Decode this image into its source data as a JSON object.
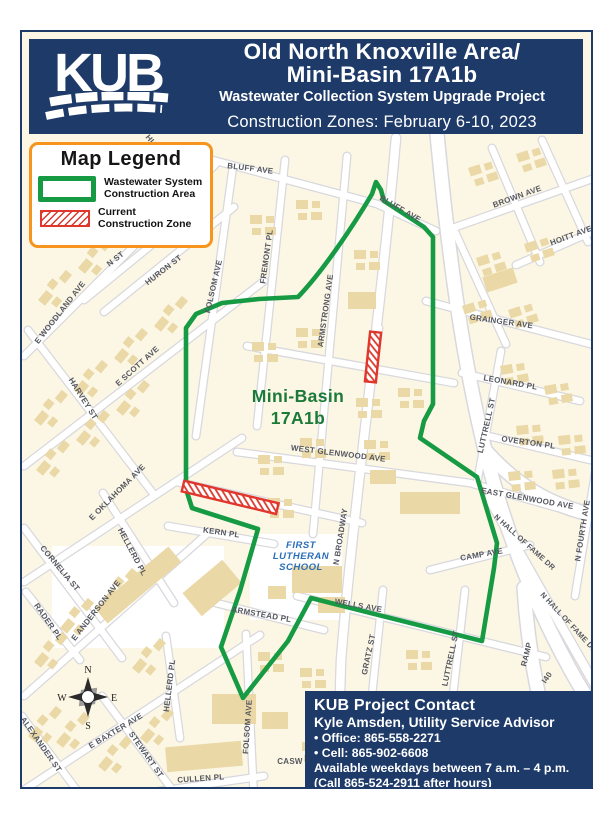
{
  "header": {
    "logo_text": "KUB",
    "title_line1": "Old North Knoxville Area/",
    "title_line2": "Mini-Basin 17A1b",
    "subtitle": "Wastewater Collection System Upgrade Project",
    "banner": "Construction Zones: February 6-10, 2023"
  },
  "legend": {
    "title": "Map Legend",
    "items": [
      {
        "swatch": "green-outline",
        "label_line1": "Wastewater System",
        "label_line2": "Construction Area"
      },
      {
        "swatch": "red-hatched",
        "label_line1": "Current",
        "label_line2": "Construction Zone"
      }
    ]
  },
  "map": {
    "basin_label_line1": "Mini-Basin",
    "basin_label_line2": "17A1b",
    "school_label": [
      "FIRST",
      "LUTHERAN",
      "SCHOOL"
    ],
    "compass": {
      "n": "N",
      "s": "S",
      "e": "E",
      "w": "W"
    },
    "colors": {
      "construction_area_green": "#169a43",
      "construction_zone_red": "#e0362b",
      "map_background": "#fcf7e5",
      "building_tan": "#ead8a6",
      "navy": "#1d3a69",
      "legend_orange": "#f7941d"
    },
    "street_labels": [
      {
        "text": "BLUFF AVE"
      },
      {
        "text": "BLUFF AVE"
      },
      {
        "text": "BROWN AVE"
      },
      {
        "text": "HOITT AVE"
      },
      {
        "text": "GRAINGER AVE"
      },
      {
        "text": "LEONARD PL"
      },
      {
        "text": "LUTTRELL ST"
      },
      {
        "text": "OVERTON PL"
      },
      {
        "text": "EAST GLENWOOD AVE"
      },
      {
        "text": "N FOURTH AVE"
      },
      {
        "text": "N HALL OF FAME DR"
      },
      {
        "text": "N HALL OF FAME DR"
      },
      {
        "text": "RAMP"
      },
      {
        "text": "I40"
      },
      {
        "text": "CAMP AVE"
      },
      {
        "text": "WELLS AVE"
      },
      {
        "text": "GRATZ ST"
      },
      {
        "text": "LUTTRELL ST"
      },
      {
        "text": "N BROADWAY"
      },
      {
        "text": "WEST GLENWOOD AVE"
      },
      {
        "text": "ARMSTEAD PL"
      },
      {
        "text": "KERN PL"
      },
      {
        "text": "ARMSTRONG AVE"
      },
      {
        "text": "FREMONT PL"
      },
      {
        "text": "FOLSOM AVE"
      },
      {
        "text": "FOLSOM AVE"
      },
      {
        "text": "HELLERD PL"
      },
      {
        "text": "HELLERD PL"
      },
      {
        "text": "HURON ST"
      },
      {
        "text": "N ST"
      },
      {
        "text": "E WOODLAND AVE"
      },
      {
        "text": "E SCOTT AVE"
      },
      {
        "text": "HARVEY ST"
      },
      {
        "text": "E OKLAHOMA AVE"
      },
      {
        "text": "CORNELIA ST"
      },
      {
        "text": "RADER PL"
      },
      {
        "text": "E ANDERSON AVE"
      },
      {
        "text": "ALEXANDER ST"
      },
      {
        "text": "E BAXTER AVE"
      },
      {
        "text": "STEWART ST"
      },
      {
        "text": "CULLEN PL"
      },
      {
        "text": "CASW"
      },
      {
        "text": "HU"
      }
    ]
  },
  "contact": {
    "title": "KUB Project Contact",
    "name_role": "Kyle Amsden, Utility Service Advisor",
    "office": "• Office: 865-558-2271",
    "cell": "• Cell: 865-902-6608",
    "availability": "Available weekdays between 7 a.m. – 4 p.m.",
    "after_hours": "(Call 865-524-2911 after hours)"
  }
}
